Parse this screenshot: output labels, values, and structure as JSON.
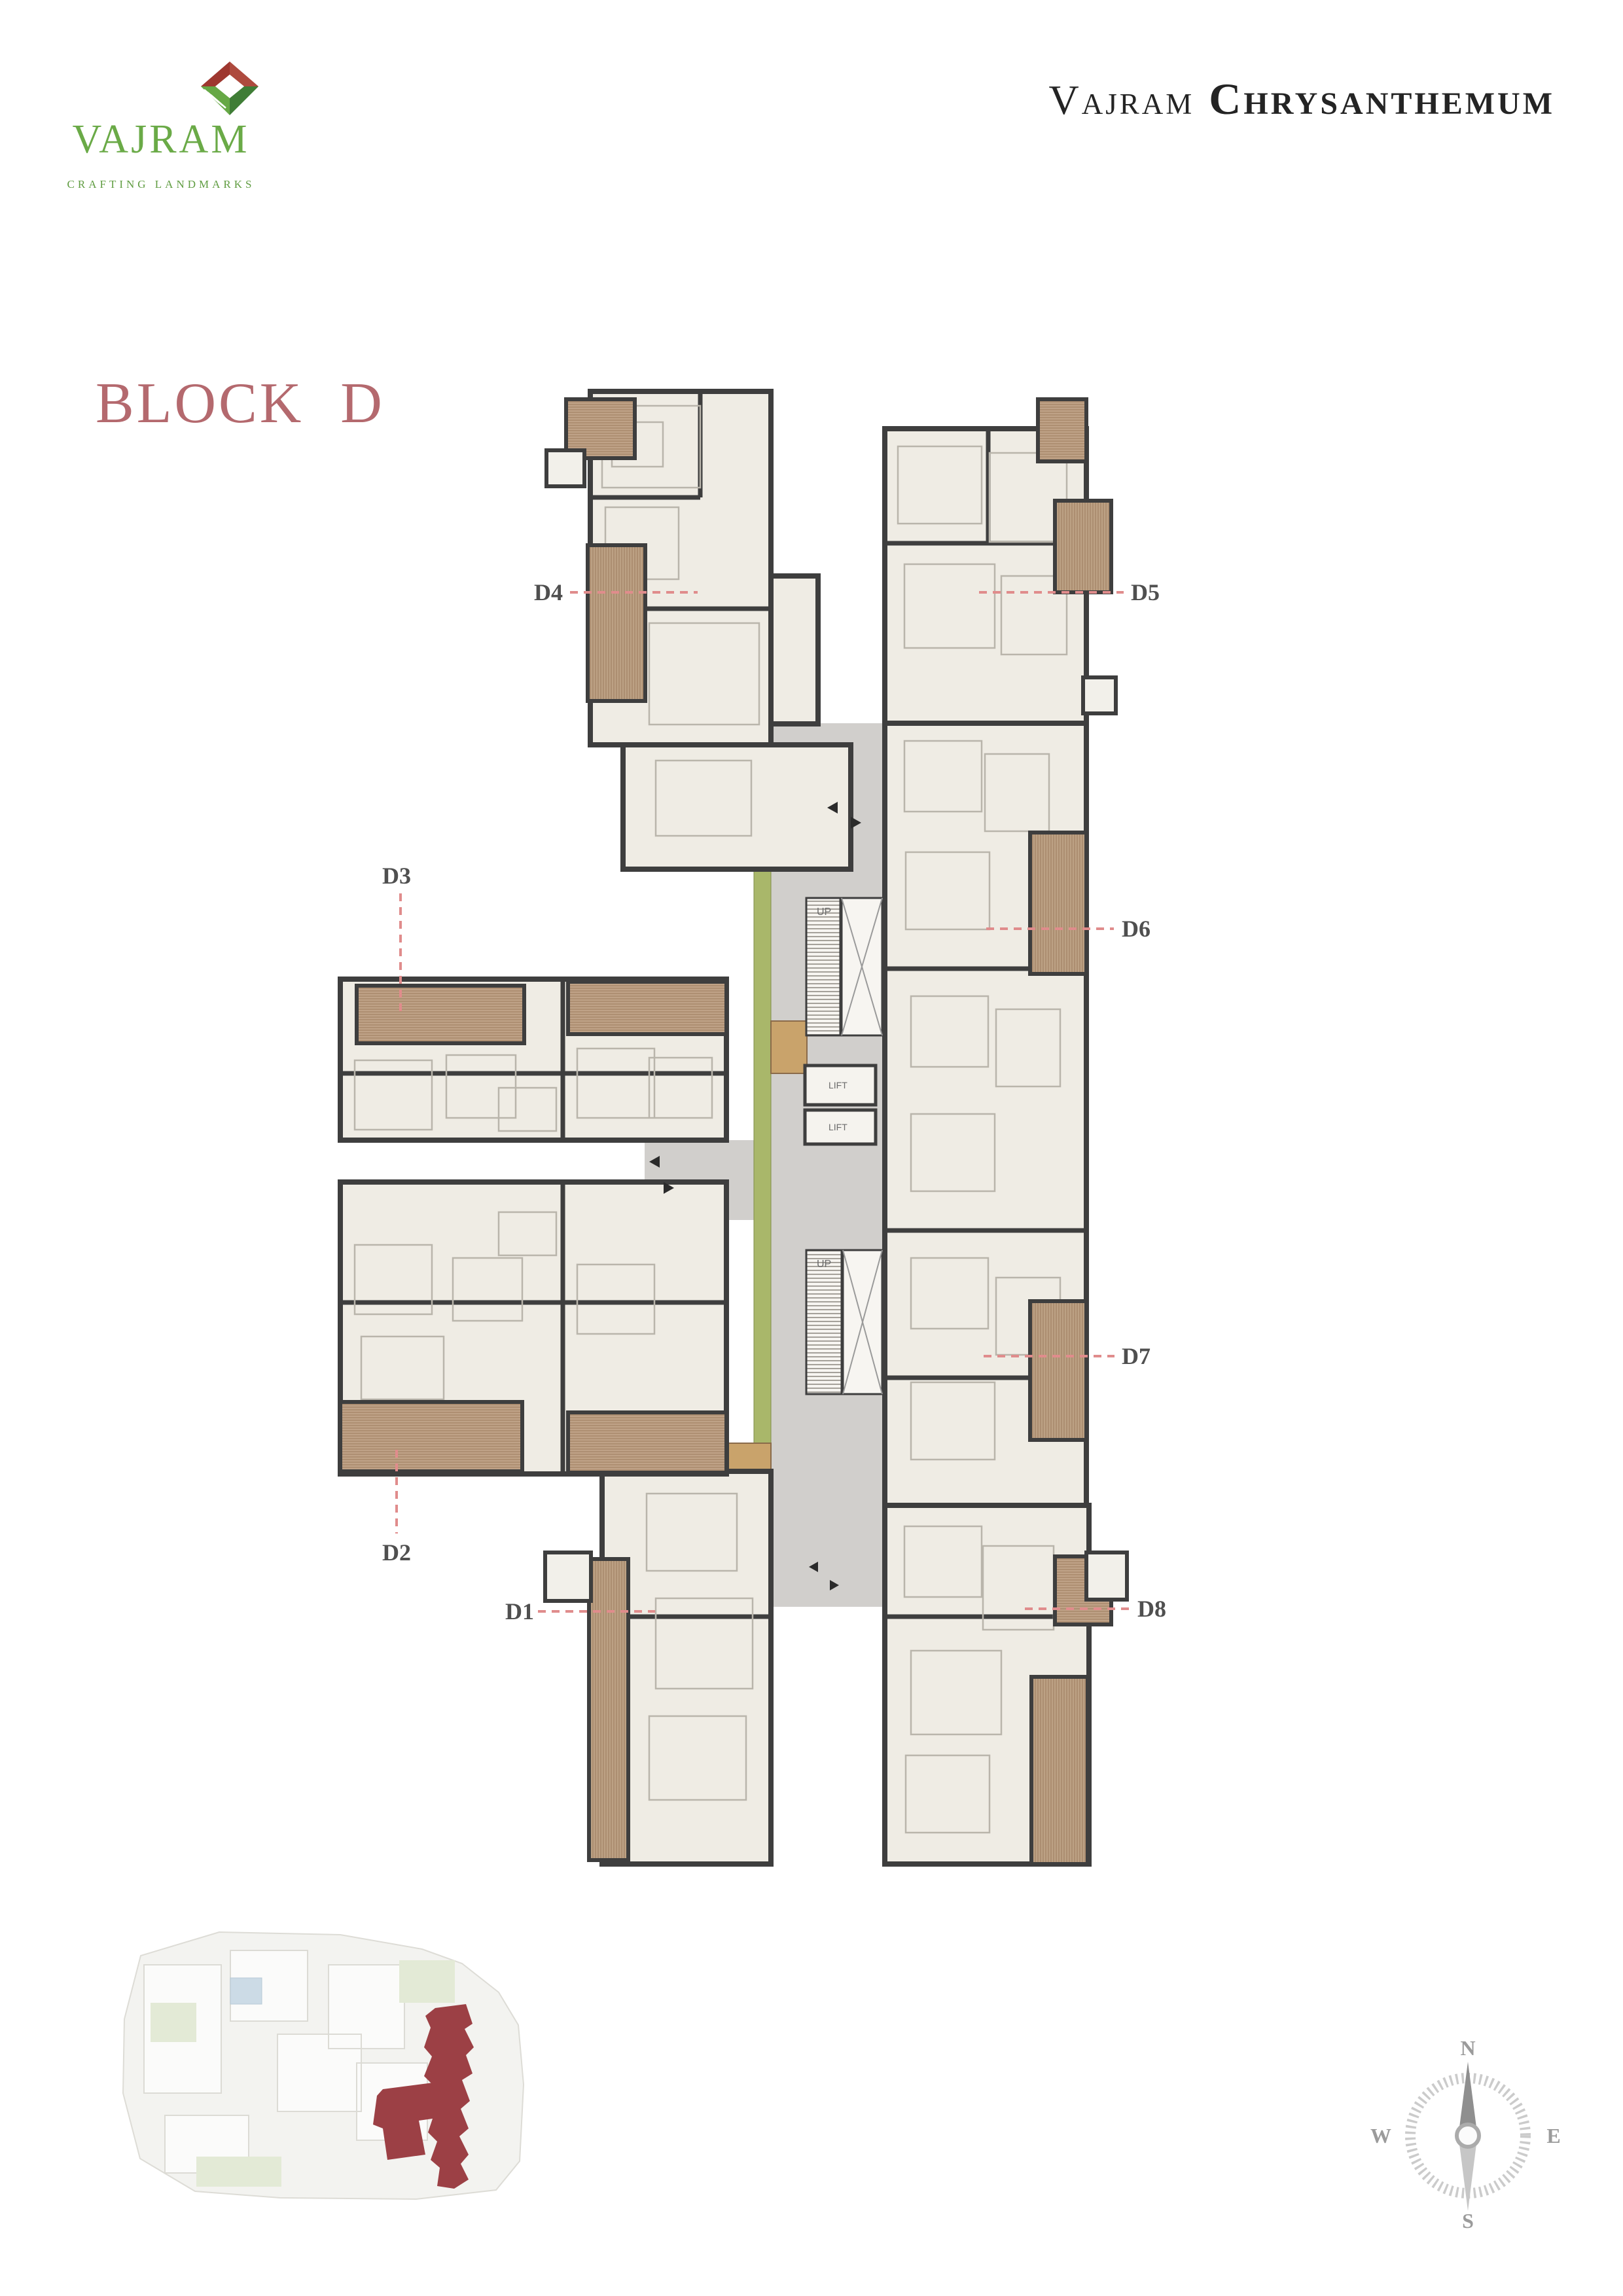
{
  "brand": {
    "name": "VAJRAM",
    "tagline": "CRAFTING LANDMARKS"
  },
  "project": {
    "title_regular": "Vajram",
    "title_bold": "Chrysanthemum"
  },
  "page_title": "BLOCK D",
  "floor_plan": {
    "units": [
      {
        "label": "D1"
      },
      {
        "label": "D2"
      },
      {
        "label": "D3"
      },
      {
        "label": "D4"
      },
      {
        "label": "D5"
      },
      {
        "label": "D6"
      },
      {
        "label": "D7"
      },
      {
        "label": "D8"
      }
    ],
    "up_label": "UP",
    "lift_label": "LIFT"
  },
  "compass": {
    "north": "N",
    "east": "E",
    "south": "S",
    "west": "W"
  },
  "colors": {
    "accent_rose": "#b4696e",
    "leader_pink": "#e08c8c",
    "wall_dark": "#3e3e3e",
    "room_fill": "#efece4",
    "balcony_wood": "#bfa287",
    "corridor_gray": "#d1cfcc",
    "landscape_green": "#a9b76a",
    "brand_green": "#6aaa47",
    "site_highlight_maroon": "#9c4045"
  }
}
